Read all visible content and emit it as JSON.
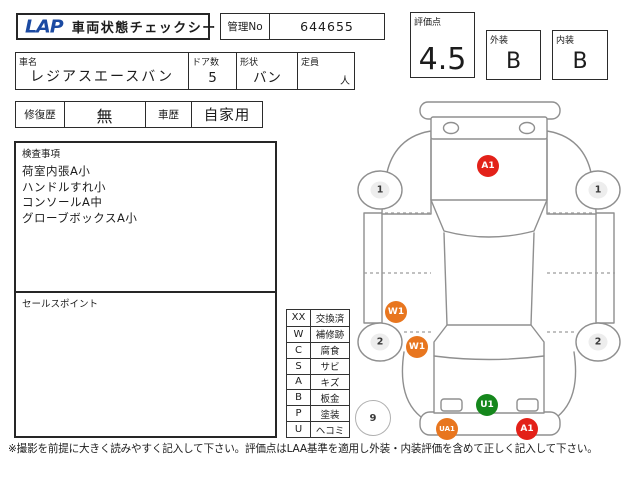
{
  "header": {
    "logo": "LAP",
    "title": "車両状態チェックシート",
    "manage_no_label": "管理No",
    "manage_no_value": "644655",
    "score_label": "評価点",
    "score_value": "4.5",
    "exterior_label": "外装",
    "exterior_value": "B",
    "interior_label": "内装",
    "interior_value": "B"
  },
  "vehicle": {
    "name_label": "車名",
    "name_value": "レジアスエースバン",
    "doors_label": "ドア数",
    "doors_value": "5",
    "shape_label": "形状",
    "shape_value": "バン",
    "capacity_label": "定員",
    "capacity_value": "",
    "capacity_unit": "人",
    "repair_label": "修復歴",
    "repair_value": "無",
    "history_label": "車歴",
    "history_value": "自家用"
  },
  "inspection": {
    "label": "検査事項",
    "items": [
      "荷室内張A小",
      "ハンドルすれ小",
      "コンソールA中",
      "グローブボックスA小"
    ]
  },
  "sales_point": {
    "label": "セールスポイント"
  },
  "legend": {
    "rows": [
      {
        "code": "XX",
        "label": "交換済"
      },
      {
        "code": "W",
        "label": "補修跡"
      },
      {
        "code": "C",
        "label": "腐食"
      },
      {
        "code": "S",
        "label": "サビ"
      },
      {
        "code": "A",
        "label": "キズ"
      },
      {
        "code": "B",
        "label": "板金"
      },
      {
        "code": "P",
        "label": "塗装"
      },
      {
        "code": "U",
        "label": "ヘコミ"
      }
    ]
  },
  "diagram": {
    "damage_markers": [
      {
        "label": "A1",
        "color": "#e32119",
        "x": 488,
        "y": 166
      },
      {
        "label": "W1",
        "color": "#e8761f",
        "x": 396,
        "y": 312
      },
      {
        "label": "W1",
        "color": "#e8761f",
        "x": 417,
        "y": 347
      },
      {
        "label": "U1",
        "color": "#15871c",
        "x": 487,
        "y": 405
      },
      {
        "label": "UA1",
        "color": "#e8761f",
        "x": 447,
        "y": 429
      },
      {
        "label": "A1",
        "color": "#e32119",
        "x": 527,
        "y": 429
      }
    ],
    "wheel_numbers": [
      {
        "label": "1",
        "x": 380,
        "y": 190
      },
      {
        "label": "1",
        "x": 598,
        "y": 190
      },
      {
        "label": "2",
        "x": 380,
        "y": 342
      },
      {
        "label": "2",
        "x": 598,
        "y": 342
      }
    ],
    "circle_numbers": [
      {
        "label": "9",
        "x": 373,
        "y": 418
      }
    ]
  },
  "footer": {
    "note": "※撮影を前提に大きく読みやすく記入して下さい。評価点はLAA基準を適用し外装・内装評価を含めて正しく記入して下さい。"
  },
  "colors": {
    "logo_blue": "#1b4aa2",
    "marker_red": "#e32119",
    "marker_orange": "#e8761f",
    "marker_green": "#15871c"
  }
}
